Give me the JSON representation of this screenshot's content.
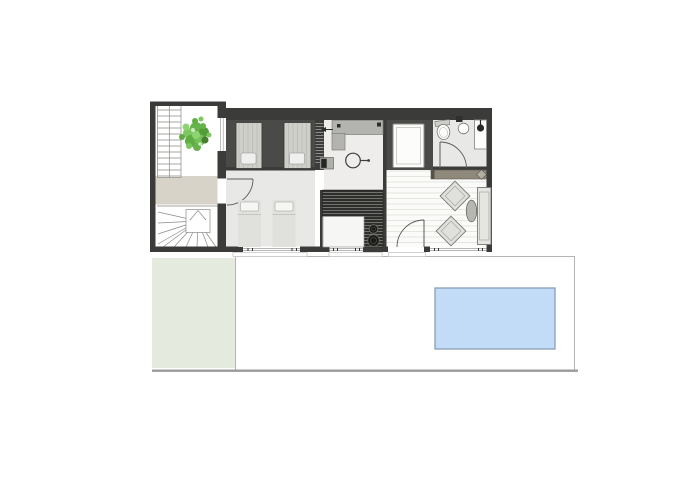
{
  "title": "single-storey house floor plan with terrace and pool",
  "colors": {
    "wall": "#3b3b39",
    "dark_floor": "#4a4a48",
    "light_floor": "#e8e8e6",
    "vanity_floor": "#eeedeb",
    "landing": "#d7d3c8",
    "grass": "#e5eadf",
    "pool_fill": "#c2dbf7",
    "pool_stroke": "#8a9fb5",
    "terrace_stroke": "#b4b4b2",
    "ground_line": "#9b9b99",
    "wood_floor": "#fbfbf9",
    "wood_line": "#e3e3df",
    "kitchen_dark": "#2e2e2c",
    "counter": "#b3b3af",
    "sideboard": "#8e897b",
    "furniture_light": "#e0e0dc",
    "bed_upper": "#cfcfca",
    "tree_greens": [
      "#66b54a",
      "#7cc75e",
      "#529e38",
      "#8fd473",
      "#467f2e"
    ]
  },
  "plan": {
    "stairwell": {
      "stairs": [
        "straight-flight",
        "winder-flight"
      ],
      "planter_tree": 1
    },
    "upper_bedroom": {
      "beds": 2,
      "wardrobe": 1
    },
    "lower_bedroom": {
      "beds": 2,
      "door": 1
    },
    "vanity_room": {
      "counter": 1,
      "drain_symbol": 1
    },
    "shower_room": {
      "shower_tray": 1
    },
    "bathroom": {
      "fixtures": [
        "toilet",
        "washbasin",
        "shower-head"
      ],
      "door": 1
    },
    "kitchen": {
      "burners": 2,
      "island": 1
    },
    "living_room": {
      "furniture": [
        "sideboard",
        "armchair",
        "armchair",
        "coffee-table",
        "sofa"
      ],
      "entry_door": 1
    },
    "exterior": {
      "terrace": 1,
      "pool": 1,
      "lawn": 1,
      "window_bays": 3,
      "thresholds": 3
    }
  }
}
